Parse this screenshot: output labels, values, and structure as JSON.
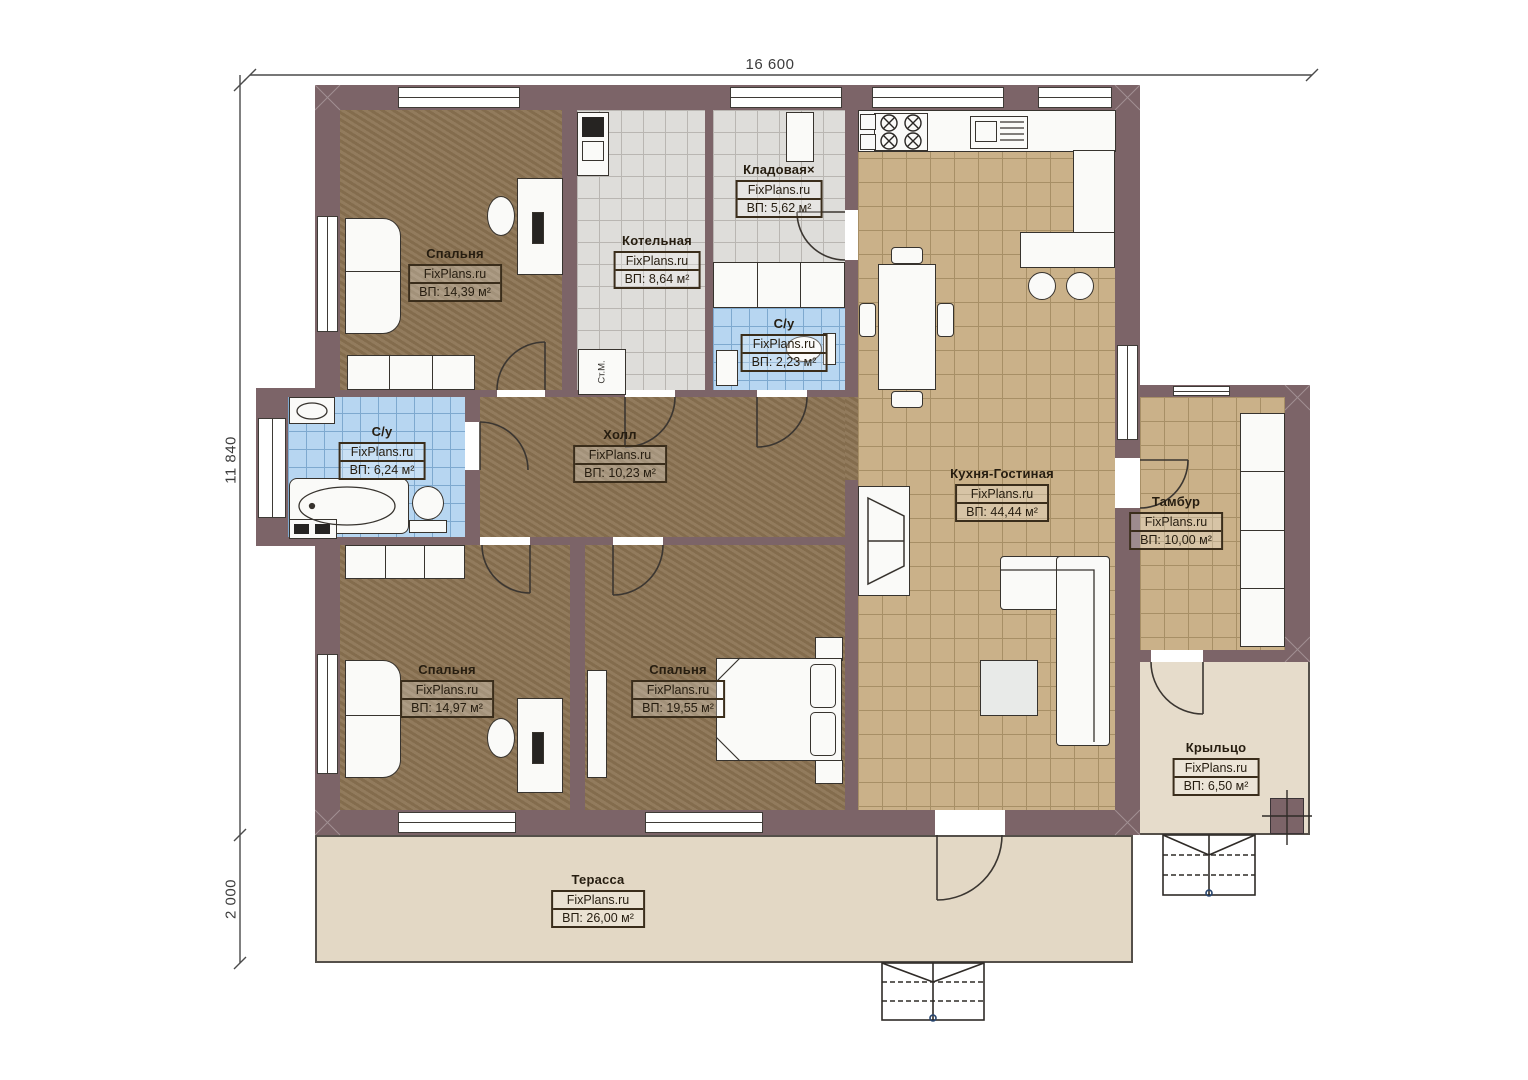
{
  "watermark": "FixPlans.ru",
  "dimensions": {
    "width": "16 600",
    "height": "11 840",
    "terrace_depth": "2 000"
  },
  "rooms": [
    {
      "name": "Спальня",
      "watermark": "FixPlans.ru",
      "area": "ВП: 14,39 м²"
    },
    {
      "name": "Котельная",
      "watermark": "FixPlans.ru",
      "area": "ВП: 8,64 м²"
    },
    {
      "name": "Кладовая×",
      "watermark": "FixPlans.ru",
      "area": "ВП: 5,62 м²"
    },
    {
      "name": "С/у",
      "watermark": "FixPlans.ru",
      "area": "ВП: 2,23 м²"
    },
    {
      "name": "Кухня-Гостиная",
      "watermark": "FixPlans.ru",
      "area": "ВП: 44,44 м²"
    },
    {
      "name": "Тамбур",
      "watermark": "FixPlans.ru",
      "area": "ВП: 10,00 м²"
    },
    {
      "name": "Холл",
      "watermark": "FixPlans.ru",
      "area": "ВП: 10,23 м²"
    },
    {
      "name": "С/у",
      "watermark": "FixPlans.ru",
      "area": "ВП: 6,24 м²"
    },
    {
      "name": "Спальня",
      "watermark": "FixPlans.ru",
      "area": "ВП: 14,97 м²"
    },
    {
      "name": "Спальня",
      "watermark": "FixPlans.ru",
      "area": "ВП: 19,55 м²"
    },
    {
      "name": "Крыльцо",
      "watermark": "FixPlans.ru",
      "area": "ВП: 6,50 м²"
    },
    {
      "name": "Терасса",
      "watermark": "FixPlans.ru",
      "area": "ВП: 26,00 м²"
    }
  ],
  "labels": {
    "washing_machine": "Ст.М."
  },
  "colors": {
    "wall": "#7c6468",
    "floor_wood": "#8c7454",
    "tile_tan": "#cab189",
    "tile_blue": "#b7d6f1",
    "tile_gray": "#deddda",
    "outdoor": "#e3d8c5"
  }
}
